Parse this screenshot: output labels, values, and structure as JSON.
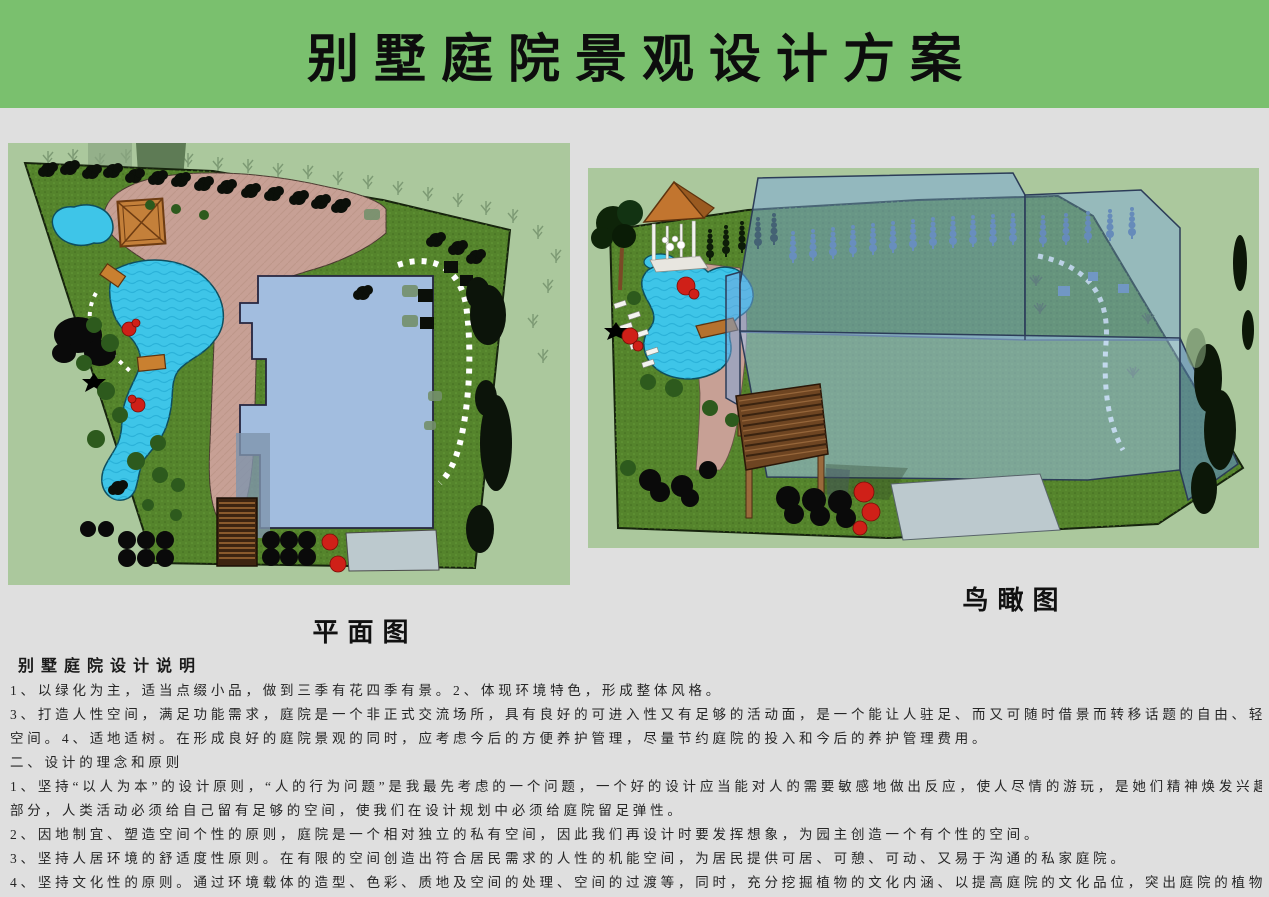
{
  "banner": {
    "title": "别墅庭院景观设计方案",
    "bg_color": "#7ac06e",
    "text_color": "#0d0d0d"
  },
  "plan_view": {
    "caption": "平面图"
  },
  "bird_view": {
    "caption": "鸟瞰图"
  },
  "description": {
    "heading": "别墅庭院设计说明",
    "lines": [
      "1、以绿化为主，适当点缀小品，做到三季有花四季有景。2、体现环境特色，形成整体风格。",
      "3、打造人性空间，满足功能需求，庭院是一个非正式交流场所，具有良好的可进入性又有足够的活动面，是一个能让人驻足、而又可随时借景而转移话题的自由、轻松的自由",
      "空间。4、适地适树。在形成良好的庭院景观的同时，应考虑今后的方便养护管理，尽量节约庭院的投入和今后的养护管理费用。",
      "二、设计的理念和原则",
      "1、坚持“以人为本”的设计原则，“人的行为问题”是我最先考虑的一个问题，一个好的设计应当能对人的需要敏感地做出反应，使人尽情的游玩，是她们精神焕发兴趣，一",
      "部分，人类活动必须给自己留有足够的空间，使我们在设计规划中必须给庭院留足弹性。",
      "2、因地制宜、塑造空间个性的原则，庭院是一个相对独立的私有空间，因此我们再设计时要发挥想象，为园主创造一个有个性的空间。",
      "3、坚持人居环境的舒适度性原则。在有限的空间创造出符合居民需求的人性的机能空间，为居民提供可居、可憩、可动、又易于沟通的私家庭院。",
      "4、坚持文化性的原则。通过环境载体的造型、色彩、质地及空间的处理、空间的过渡等，同时，充分挖掘植物的文化内涵、以提高庭院的文化品位，突出庭院的植物景观特点"
    ]
  },
  "palette": {
    "page_bg": "#dfdfdf",
    "banner_green": "#7ac06e",
    "panel_bg": "#abc89d",
    "grass": "#55842c",
    "paving_tan": "#c7a095",
    "water_cyan": "#3ec5e8",
    "house_blue": "#a2bddf",
    "glass_blue": "#7ca8e0",
    "wood_brown": "#6e4522",
    "tree_dark": "#0c140a",
    "shrub_green": "#2d5a1d",
    "flower_red": "#cf2018",
    "driveway_gray": "#bcc9ce"
  }
}
